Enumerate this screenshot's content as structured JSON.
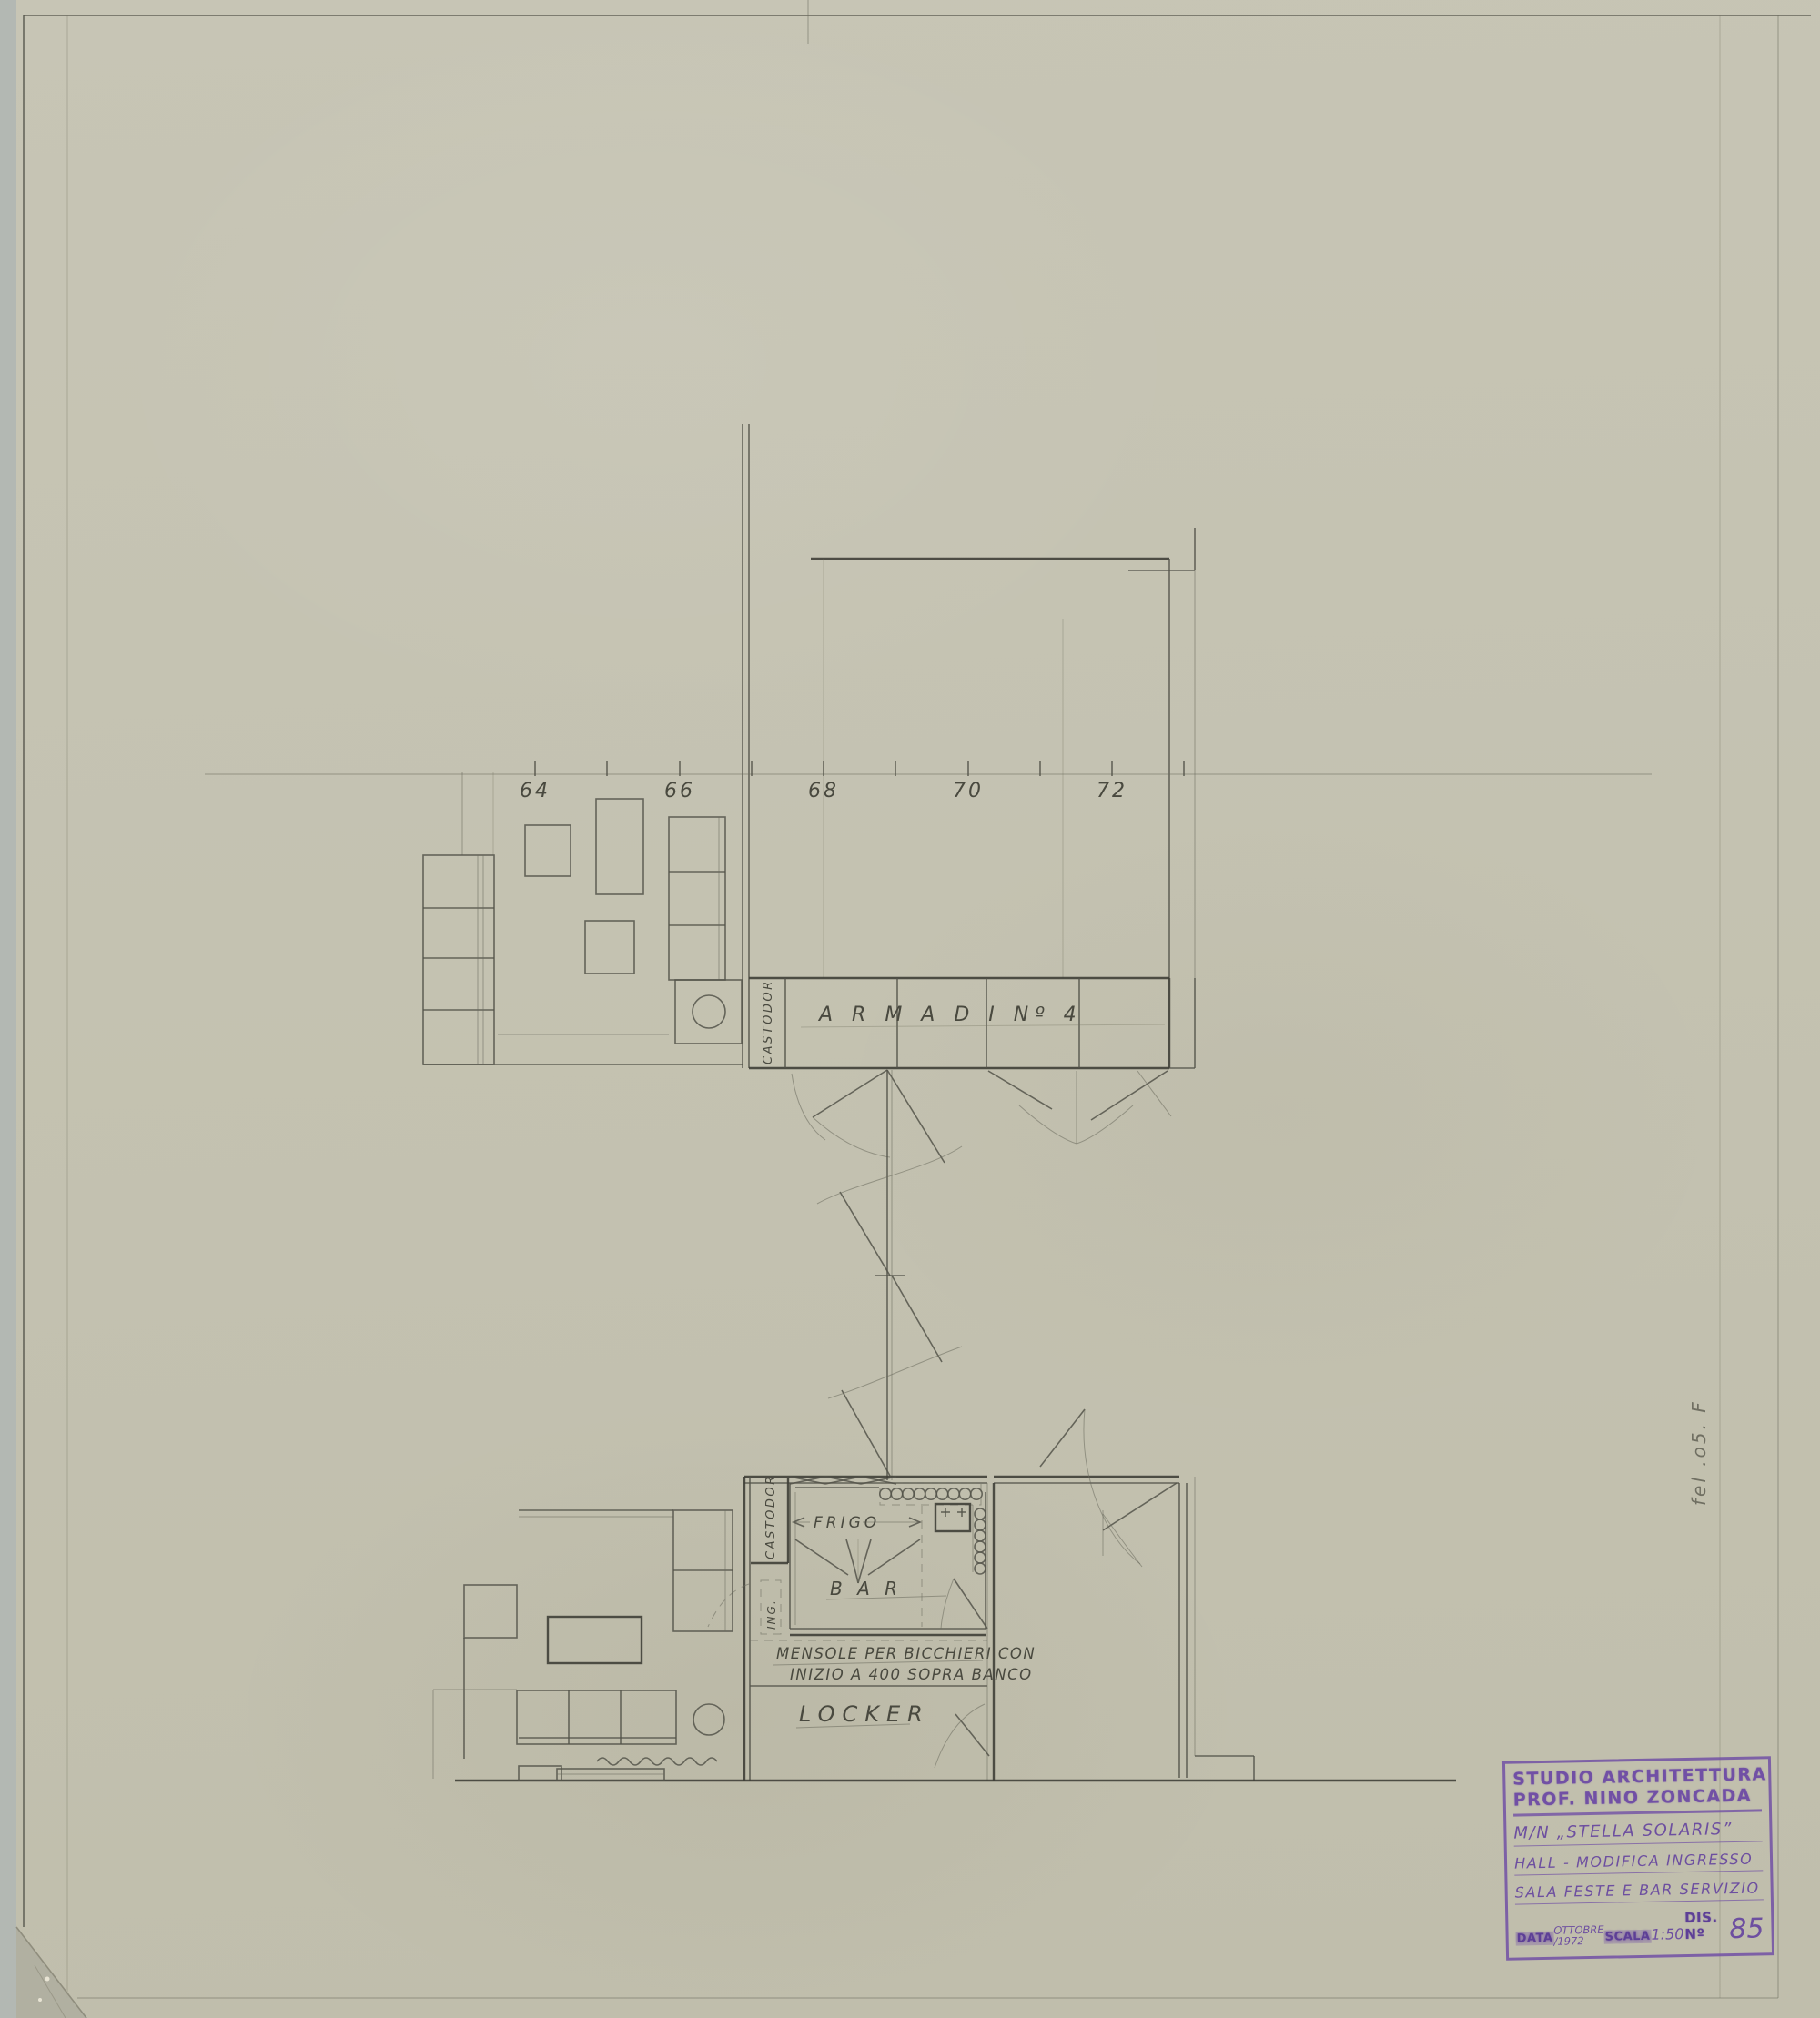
{
  "colors": {
    "paper": "#c5c3b2",
    "pencil": "#4a4a40",
    "stamp_purple": "#7150a5",
    "scan_background": "#b3b8b3"
  },
  "upper_plan": {
    "frame_labels": [
      "64",
      "66",
      "68",
      "70",
      "72"
    ],
    "castodor_label": "CASTODOR",
    "armadi_label": "A R M A D I   Nº 4"
  },
  "lower_plan": {
    "castodor_label": "CASTODOR",
    "frigo_label": "FRIGO",
    "bar_label": "B A R",
    "ing_label": "ING.",
    "mensole_line1": "MENSOLE PER BICCHIERI CON",
    "mensole_line2": "INIZIO A 400 SOPRA BANCO",
    "locker_label": "LOCKER"
  },
  "margin_note": "fel .o5. F",
  "title_block": {
    "studio_line1": "STUDIO ARCHITETTURA",
    "studio_line2": "PROF. NINO ZONCADA",
    "vessel": "M/N „STELLA SOLARIS”",
    "subject_line1": "HALL - MODIFICA INGRESSO",
    "subject_line2": "SALA FESTE E BAR SERVIZIO",
    "data_label": "DATA",
    "data_value_top": "OTTOBRE",
    "data_value_bottom": "/1972",
    "scala_label": "SCALA",
    "scala_value": "1:50",
    "dis_label": "DIS. Nº",
    "dis_value": "85"
  }
}
